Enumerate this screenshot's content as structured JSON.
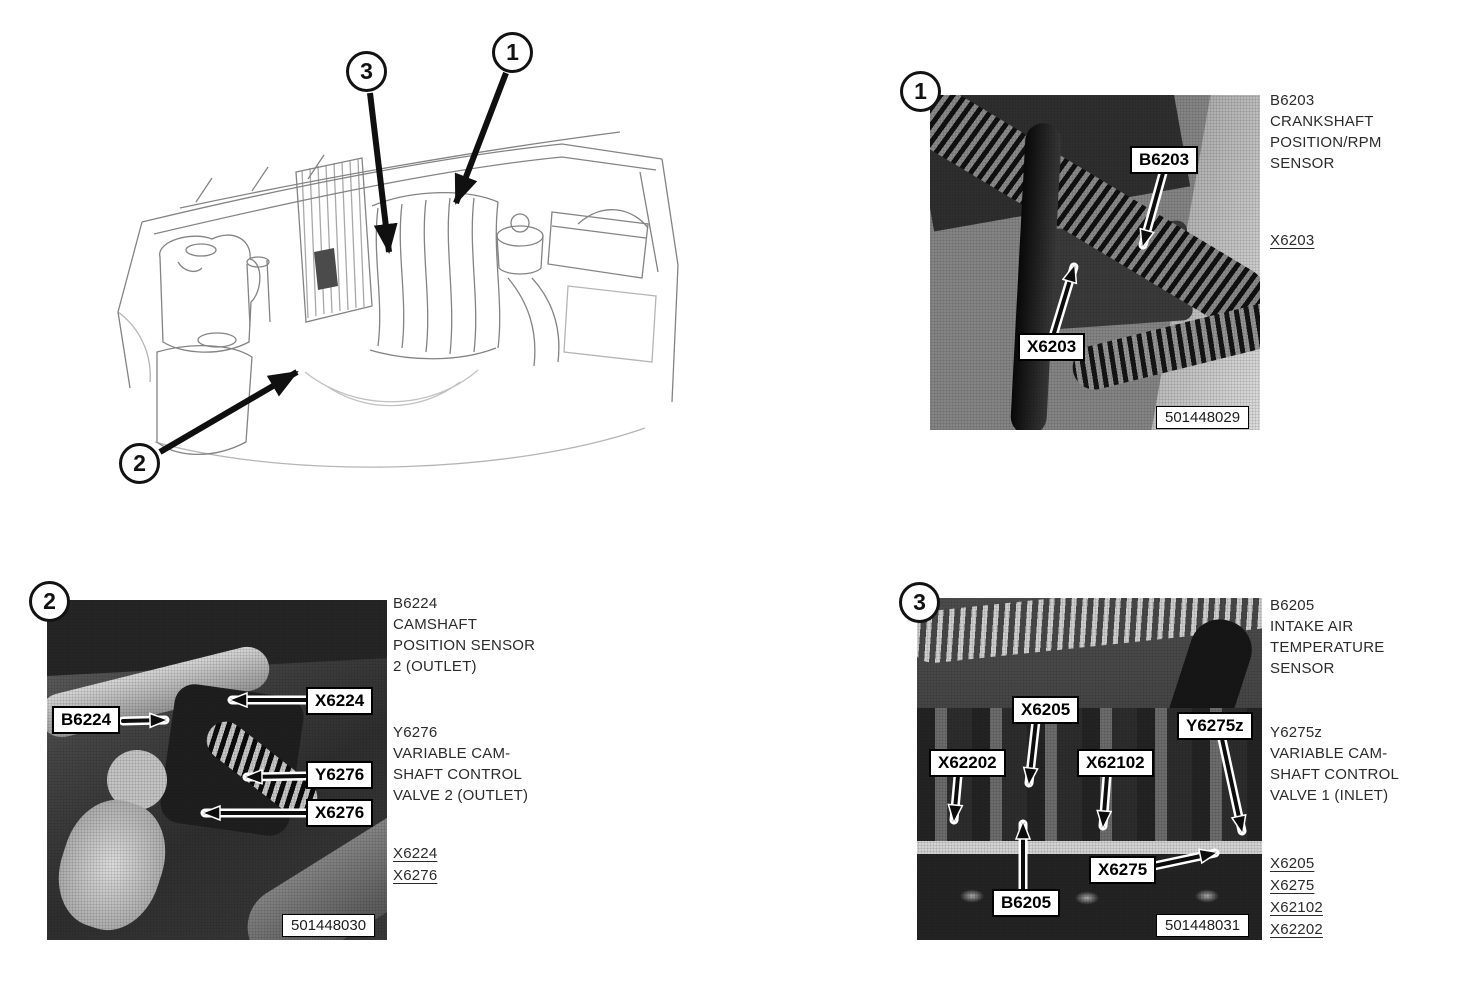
{
  "colors": {
    "page_bg": "#ffffff",
    "ink": "#1f1f1f",
    "label_bg": "#ffffff",
    "label_border": "#000000"
  },
  "overview": {
    "callouts": [
      {
        "number": "1"
      },
      {
        "number": "2"
      },
      {
        "number": "3"
      }
    ]
  },
  "panels": [
    {
      "badge": "1",
      "photo_code": "501448029",
      "callout_labels": [
        {
          "text": "B6203"
        },
        {
          "text": "X6203"
        }
      ],
      "descriptions": [
        {
          "lines": [
            "B6203",
            "CRANKSHAFT",
            "POSITION/RPM",
            "SENSOR"
          ]
        }
      ],
      "links": [
        {
          "text": "X6203"
        }
      ]
    },
    {
      "badge": "2",
      "photo_code": "501448030",
      "callout_labels": [
        {
          "text": "B6224"
        },
        {
          "text": "X6224"
        },
        {
          "text": "Y6276"
        },
        {
          "text": "X6276"
        }
      ],
      "descriptions": [
        {
          "lines": [
            "B6224",
            "CAMSHAFT",
            "POSITION SENSOR",
            "2 (OUTLET)"
          ]
        },
        {
          "lines": [
            "Y6276",
            "VARIABLE CAM-",
            "SHAFT CONTROL",
            "VALVE 2 (OUTLET)"
          ]
        }
      ],
      "links": [
        {
          "text": "X6224"
        },
        {
          "text": "X6276"
        }
      ]
    },
    {
      "badge": "3",
      "photo_code": "501448031",
      "callout_labels": [
        {
          "text": "X6205"
        },
        {
          "text": "Y6275z"
        },
        {
          "text": "X62202"
        },
        {
          "text": "X62102"
        },
        {
          "text": "X6275"
        },
        {
          "text": "B6205"
        }
      ],
      "descriptions": [
        {
          "lines": [
            "B6205",
            "INTAKE AIR",
            "TEMPERATURE",
            "SENSOR"
          ]
        },
        {
          "lines": [
            "Y6275z",
            "VARIABLE CAM-",
            "SHAFT CONTROL",
            "VALVE 1 (INLET)"
          ]
        }
      ],
      "links": [
        {
          "text": "X6205"
        },
        {
          "text": "X6275"
        },
        {
          "text": "X62102"
        },
        {
          "text": "X62202"
        }
      ]
    }
  ]
}
